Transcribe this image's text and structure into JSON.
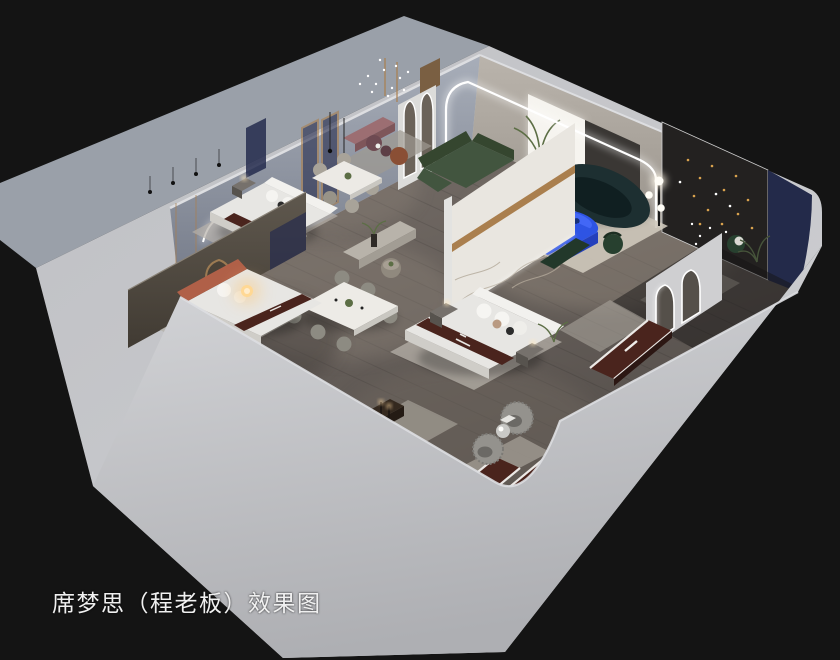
{
  "caption": {
    "text": "席梦思（程老板）效果图"
  },
  "scene": {
    "subject": "isometric-cutaway-interior-render",
    "areas": [
      {
        "id": "bedroom-top-left",
        "label": "bedroom display with wavy LED wall art"
      },
      {
        "id": "bedroom-terracotta",
        "label": "bedroom display with terracotta headboard"
      },
      {
        "id": "dining-area",
        "label": "two marble dining sets"
      },
      {
        "id": "center-bed-display",
        "label": "bed with marble feature wall"
      },
      {
        "id": "living-room",
        "label": "green sectional, dark curved sofa, blue table"
      },
      {
        "id": "dark-bedroom-right",
        "label": "dark room with arch doorways and string lights"
      },
      {
        "id": "mattress-display-corner",
        "label": "three branded mattresses and fuzzy chairs"
      },
      {
        "id": "entrance-hall",
        "label": "LED arch portal and arch mirrors"
      }
    ]
  },
  "palette": {
    "bg": "#141414",
    "apron": "#9aa0a9",
    "shell": "#c6c7cb",
    "shellEdge": "#dddee1",
    "bandTop": "#d4d5d8",
    "bandBottom": "#b0b1b5",
    "wallNWTop": "#a8aeb9",
    "wallNWBottom": "#737987",
    "wallNETop": "#b9b3ab",
    "wallNEBottom": "#8e8880",
    "floorLight": "#7d746d",
    "floorDark": "#554f4b",
    "marble": "#e9e6e0",
    "marbleVein": "#b3a99a",
    "gold": "#aa7f4e",
    "navy": "#252b4d",
    "navyWall": "#232a4a",
    "panelDark": "#232120",
    "curtain": "#3a3734",
    "windowGlow": "#f6f4ef",
    "sofaGreen": "#42553f",
    "sofaGreenDark": "#35462f",
    "sofaTeal": "#1d2f31",
    "sofaTealDark": "#101f21",
    "accentBlue": "#2e54e4",
    "accentBlueDark": "#2440bc",
    "mattress": "#4a241d",
    "mattressEdge": "#ece9e6",
    "bedWhite": "#e7e6e3",
    "bedShade": "#cfcdc8",
    "terracotta": "#b06048",
    "pinkBench": "#9c6e72",
    "plum": "#6e4a52",
    "rust": "#8a4f35",
    "rugCream": "#cec8bb",
    "rugGray": "#a9a49b",
    "fuzzyGray": "#94928d",
    "benchStone": "#b8b3aa",
    "nightstand": "#76716c",
    "woodDark": "#34291f",
    "glowWarm": "#ffc873",
    "led": "#ffffff",
    "greenPlant": "#5c6e45",
    "darkGreen": "#27402f",
    "caption": "#f0f0f0"
  }
}
